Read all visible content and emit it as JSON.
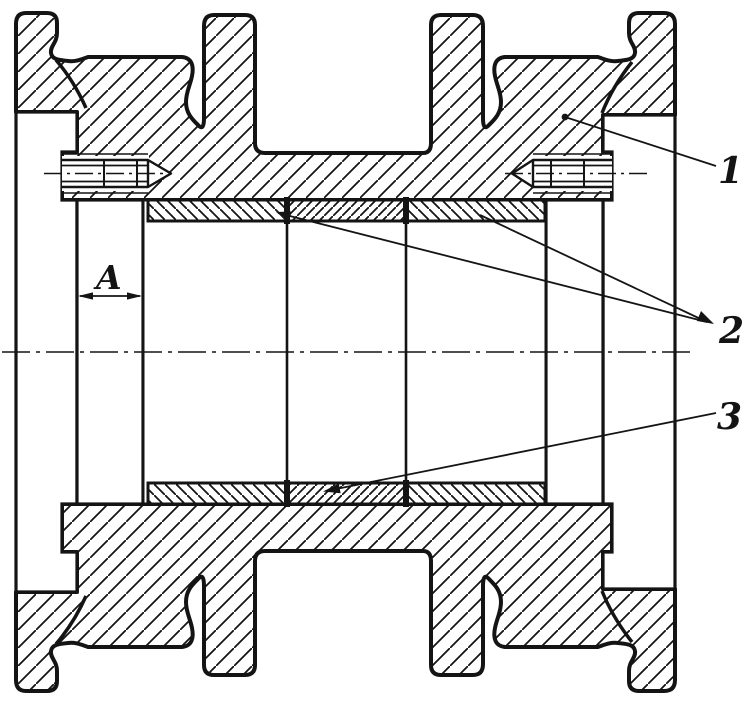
{
  "figure": {
    "kind": "engineering-cross-section-roller",
    "description": "Sectional view of a track roller body on axle with bushings, spacer sleeve and oil plugs",
    "callouts": [
      {
        "label": "1",
        "target": "roller-body"
      },
      {
        "label": "2",
        "target": "bushings"
      },
      {
        "label": "3",
        "target": "spacer-sleeve"
      }
    ],
    "dimension": {
      "label": "A",
      "meaning": "axial clearance gap"
    },
    "colors": {
      "ink": "#141414",
      "paper": "#ffffff"
    }
  }
}
